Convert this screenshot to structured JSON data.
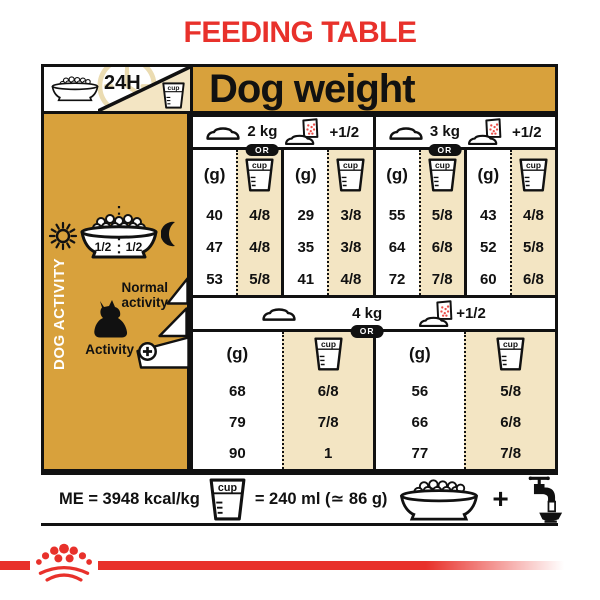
{
  "title": "FEEDING TABLE",
  "colors": {
    "gold": "#D8A13C",
    "cream": "#F3E5C3",
    "red": "#E8312B",
    "ink": "#111111"
  },
  "header": {
    "hours_label": "24H",
    "cup_label": "cup",
    "dog_weight_label": "Dog weight"
  },
  "sidebar": {
    "dog_activity_label": "DOG ACTIVITY",
    "bowl_half_left": "1/2",
    "bowl_half_right": "1/2",
    "normal_activity_label": "Normal activity",
    "activity_plus_label": "Activity"
  },
  "table": {
    "grams_header": "(g)",
    "or_label": "OR",
    "plus_half_label": "+1/2",
    "weights": [
      {
        "label": "2 kg"
      },
      {
        "label": "3 kg"
      },
      {
        "label": "4 kg"
      }
    ],
    "cols": [
      {
        "g": [
          "40",
          "47",
          "53"
        ],
        "cup": [
          "4/8",
          "4/8",
          "5/8"
        ]
      },
      {
        "g": [
          "29",
          "35",
          "41"
        ],
        "cup": [
          "3/8",
          "3/8",
          "4/8"
        ]
      },
      {
        "g": [
          "55",
          "64",
          "72"
        ],
        "cup": [
          "5/8",
          "6/8",
          "7/8"
        ]
      },
      {
        "g": [
          "43",
          "52",
          "60"
        ],
        "cup": [
          "4/8",
          "5/8",
          "6/8"
        ]
      },
      {
        "g": [
          "68",
          "79",
          "90"
        ],
        "cup": [
          "6/8",
          "7/8",
          "1"
        ]
      },
      {
        "g": [
          "56",
          "66",
          "77"
        ],
        "cup": [
          "5/8",
          "6/8",
          "7/8"
        ]
      }
    ]
  },
  "footer": {
    "me_label": "ME = 3948 kcal/kg",
    "cup_equals_label": "= 240 ml (≃ 86 g)",
    "plus_label": "+"
  },
  "icons": [
    "kibble-bowl-icon",
    "24h-clock-icon",
    "measuring-cup-icon",
    "empty-bowl-icon",
    "pouch-and-bowl-icon",
    "sun-icon",
    "moon-icon",
    "yorkshire-dog-icon",
    "plus-circle-icon",
    "activity-wedge-icon",
    "water-tap-icon",
    "crown-logo-icon"
  ]
}
